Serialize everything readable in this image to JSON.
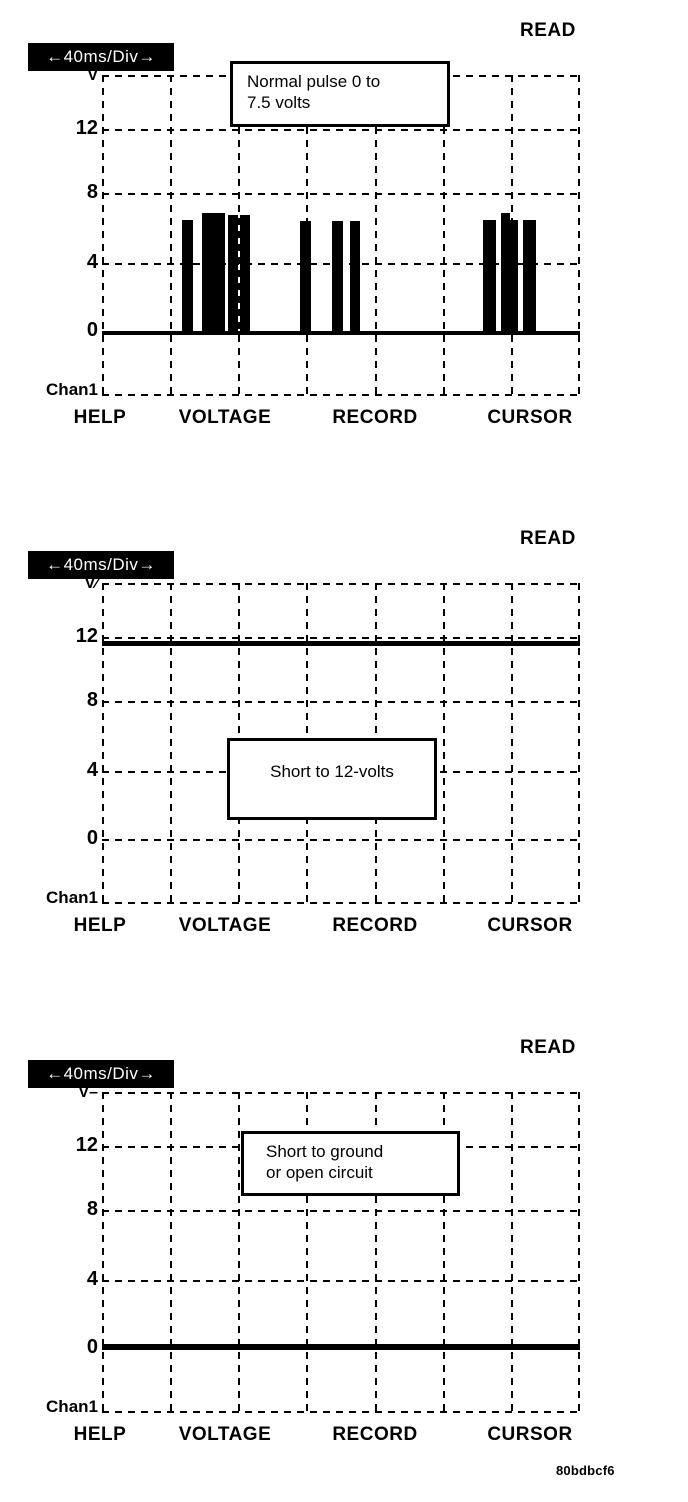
{
  "figure_id": "80bdbcf6",
  "shared": {
    "read_label": "READ",
    "timebase_label": "←40ms/Div→",
    "chan_label": "Chan1",
    "softkeys": [
      "HELP",
      "VOLTAGE",
      "RECORD",
      "CURSOR"
    ],
    "y_ticks": [
      "12",
      "8",
      "4",
      "0"
    ],
    "colors": {
      "ink": "#000000",
      "paper": "#ffffff"
    }
  },
  "panels": [
    {
      "id": "normal-pulse",
      "v_label": "V",
      "callout_lines": [
        "Normal pulse 0 to",
        "7.5 volts"
      ],
      "layout": {
        "panel_top": 15,
        "callout": {
          "left": 230,
          "top": 46,
          "width": 220,
          "height": 66,
          "align": "left"
        },
        "trace": {
          "kind": "pulses",
          "baseline": {
            "left": 102,
            "width": 478,
            "y": 316,
            "h": 4
          },
          "pulse_bottom": 320,
          "pulses": [
            {
              "x": 182,
              "w": 11,
              "t": 205
            },
            {
              "x": 202,
              "w": 23,
              "t": 198
            },
            {
              "x": 228,
              "w": 10,
              "t": 200
            },
            {
              "x": 240,
              "w": 10,
              "t": 200
            },
            {
              "x": 300,
              "w": 11,
              "t": 206
            },
            {
              "x": 332,
              "w": 11,
              "t": 206
            },
            {
              "x": 350,
              "w": 10,
              "t": 206
            },
            {
              "x": 483,
              "w": 13,
              "t": 205
            },
            {
              "x": 501,
              "w": 9,
              "t": 198
            },
            {
              "x": 501,
              "w": 17,
              "t": 205
            },
            {
              "x": 523,
              "w": 13,
              "t": 205
            }
          ]
        }
      }
    },
    {
      "id": "short-to-12v",
      "v_label": "V∕",
      "callout_lines": [
        "Short to 12-volts"
      ],
      "layout": {
        "panel_top": 523,
        "callout": {
          "left": 227,
          "top": 215,
          "width": 210,
          "height": 82,
          "align": "center"
        },
        "trace": {
          "kind": "flat",
          "line": {
            "left": 102,
            "width": 478,
            "y": 118,
            "h": 5
          }
        }
      }
    },
    {
      "id": "short-to-ground",
      "v_label": "V–",
      "callout_lines": [
        "Short to ground",
        "or open circuit"
      ],
      "layout": {
        "panel_top": 1032,
        "callout": {
          "left": 241,
          "top": 99,
          "width": 219,
          "height": 65,
          "align": "left2"
        },
        "trace": {
          "kind": "flat",
          "line": {
            "left": 102,
            "width": 478,
            "y": 312,
            "h": 6
          }
        }
      }
    }
  ],
  "chart_data": [
    {
      "type": "line",
      "title": "Normal pulse 0 to 7.5 volts",
      "xlabel": "time (40 ms/Div, 7 divisions)",
      "ylabel": "V",
      "ylim": [
        -4,
        16
      ],
      "xlim_ms": [
        0,
        280
      ],
      "y_tick_labels": [
        "V",
        "12",
        "8",
        "4",
        "0"
      ],
      "grid": "dashed, 7 columns x 5 rows, 4 V per vertical division",
      "legend_position": "none",
      "annotations": [
        "Normal pulse 0 to 7.5 volts",
        "READ",
        "40ms/Div",
        "Chan1",
        "HELP",
        "VOLTAGE",
        "RECORD",
        "CURSOR"
      ],
      "series": [
        {
          "name": "Chan1",
          "description": "0 V baseline with three bursts of rectangular pulses rising to about 6.5-7 V (annotated as 0 to 7.5 volts)",
          "low_volts": 0,
          "high_volts": 7.5,
          "pulses_ms": [
            [
              47,
              53
            ],
            [
              59,
              72
            ],
            [
              74,
              80
            ],
            [
              81,
              86
            ],
            [
              116,
              122
            ],
            [
              135,
              141
            ],
            [
              145,
              151
            ],
            [
              223,
              231
            ],
            [
              234,
              244
            ],
            [
              247,
              254
            ]
          ]
        }
      ]
    },
    {
      "type": "line",
      "title": "Short to 12-volts",
      "xlabel": "time (40 ms/Div, 7 divisions)",
      "ylabel": "V",
      "ylim": [
        -4,
        16
      ],
      "xlim_ms": [
        0,
        280
      ],
      "y_tick_labels": [
        "V",
        "12",
        "8",
        "4",
        "0"
      ],
      "grid": "dashed, 7 columns x 5 rows, 4 V per vertical division",
      "legend_position": "none",
      "annotations": [
        "Short to 12-volts",
        "READ",
        "40ms/Div",
        "Chan1",
        "HELP",
        "VOLTAGE",
        "RECORD",
        "CURSOR"
      ],
      "series": [
        {
          "name": "Chan1",
          "description": "constant flat trace",
          "constant_volts": 12
        }
      ]
    },
    {
      "type": "line",
      "title": "Short to ground or open circuit",
      "xlabel": "time (40 ms/Div, 7 divisions)",
      "ylabel": "V",
      "ylim": [
        -4,
        16
      ],
      "xlim_ms": [
        0,
        280
      ],
      "y_tick_labels": [
        "V",
        "12",
        "8",
        "4",
        "0"
      ],
      "grid": "dashed, 7 columns x 5 rows, 4 V per vertical division",
      "legend_position": "none",
      "annotations": [
        "Short to ground or open circuit",
        "READ",
        "40ms/Div",
        "Chan1",
        "HELP",
        "VOLTAGE",
        "RECORD",
        "CURSOR"
      ],
      "series": [
        {
          "name": "Chan1",
          "description": "constant flat trace",
          "constant_volts": 0
        }
      ]
    }
  ]
}
